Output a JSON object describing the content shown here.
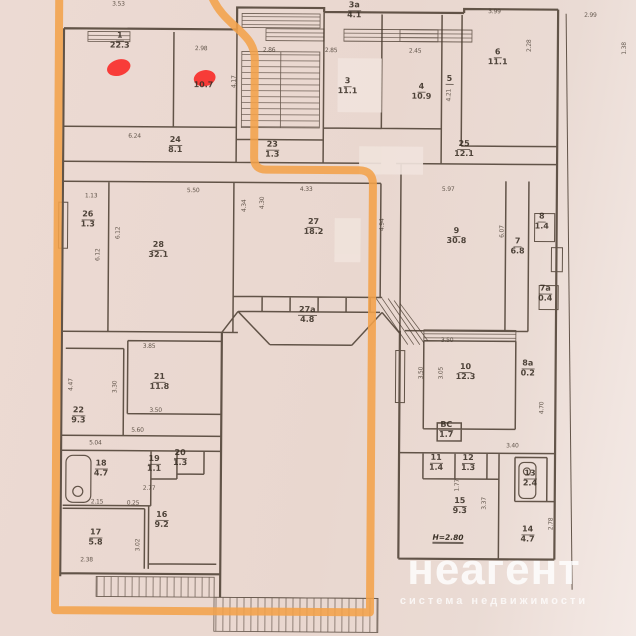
{
  "watermark": {
    "brand": "неагент",
    "tagline": "система недвижимости"
  },
  "plan": {
    "colors": {
      "highlight": "#f2a24a",
      "marker": "#f92f2c",
      "paper": "#e9d8d0",
      "ink": "#4a3c30"
    },
    "annotations": {
      "height_note": "Н=2.80"
    },
    "rooms": [
      {
        "num": "1",
        "area": "22.3"
      },
      {
        "num": "",
        "area": "10.7"
      },
      {
        "num": "3",
        "area": "11.1"
      },
      {
        "num": "4",
        "area": "10.9"
      },
      {
        "num": "5",
        "area": ""
      },
      {
        "num": "6",
        "area": "11.1"
      },
      {
        "num": "3а",
        "area": "4.1"
      },
      {
        "num": "24",
        "area": "8.1"
      },
      {
        "num": "23",
        "area": "1.3"
      },
      {
        "num": "25",
        "area": "12.1"
      },
      {
        "num": "28",
        "area": "32.1"
      },
      {
        "num": "27",
        "area": "18.2"
      },
      {
        "num": "27а",
        "area": "4.8"
      },
      {
        "num": "9",
        "area": "30.8"
      },
      {
        "num": "7",
        "area": "6.8"
      },
      {
        "num": "8",
        "area": "1.4"
      },
      {
        "num": "7а",
        "area": "0.4"
      },
      {
        "num": "8а",
        "area": "0.2"
      },
      {
        "num": "10",
        "area": "12.3"
      },
      {
        "num": "ВС",
        "area": "1.7"
      },
      {
        "num": "21",
        "area": "11.8"
      },
      {
        "num": "22",
        "area": "9.3"
      },
      {
        "num": "26",
        "area": "1.3"
      },
      {
        "num": "18",
        "area": "4.7"
      },
      {
        "num": "19",
        "area": "1.1"
      },
      {
        "num": "20",
        "area": "1.3"
      },
      {
        "num": "16",
        "area": "9.2"
      },
      {
        "num": "17",
        "area": "5.8"
      },
      {
        "num": "11",
        "area": "1.4"
      },
      {
        "num": "12",
        "area": "1.3"
      },
      {
        "num": "13",
        "area": "2.4"
      },
      {
        "num": "15",
        "area": "9.3"
      },
      {
        "num": "14",
        "area": "4.7"
      }
    ],
    "dims": [
      "3.53",
      "2.98",
      "4.17",
      "2.86",
      "2.85",
      "2.45",
      "4.21",
      "3.99",
      "2.99",
      "1.38",
      "2.28",
      "6.24",
      "1.13",
      "5.50",
      "6.12",
      "6.12",
      "4.33",
      "4.34",
      "4.30",
      "4.94",
      "5.97",
      "6.07",
      "3.85",
      "3.30",
      "3.50",
      "5.60",
      "5.04",
      "4.47",
      "2.15",
      "0.25",
      "2.77",
      "2.38",
      "3.02",
      "3.50",
      "3.50",
      "3.05",
      "4.70",
      "3.40",
      "1.77",
      "3.37",
      "2.78"
    ]
  }
}
